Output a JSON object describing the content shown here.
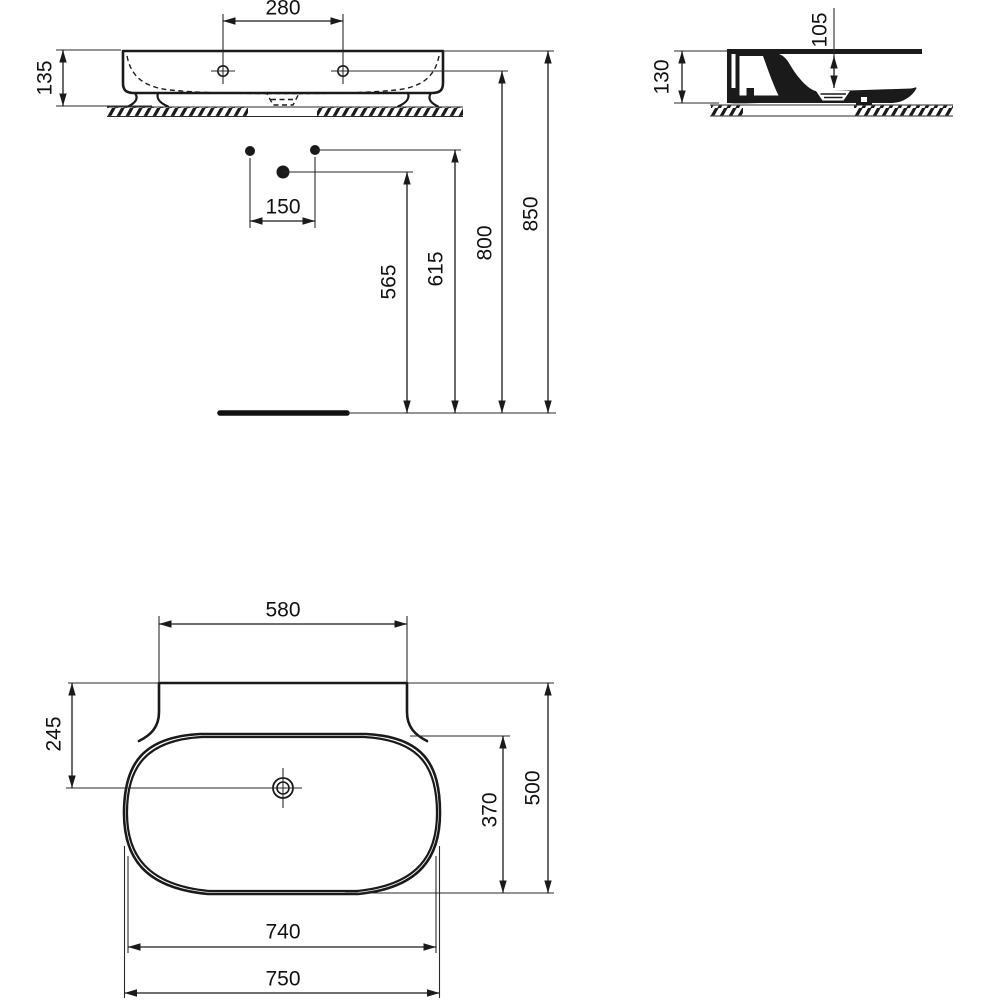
{
  "colors": {
    "background": "#ffffff",
    "line": "#1a1a1a"
  },
  "views": {
    "front": {
      "dims": {
        "tap_spacing": "280",
        "height": "135",
        "waste_offset": "150",
        "waste_height": "565",
        "inlet_height": "615",
        "tap_height": "800",
        "top_height": "850"
      }
    },
    "side": {
      "dims": {
        "height": "130",
        "bowl_depth": "105"
      }
    },
    "plan": {
      "dims": {
        "shelf_width": "580",
        "tap_setback": "245",
        "bowl_depth": "370",
        "depth": "500",
        "bowl_width": "740",
        "width": "750"
      }
    }
  }
}
